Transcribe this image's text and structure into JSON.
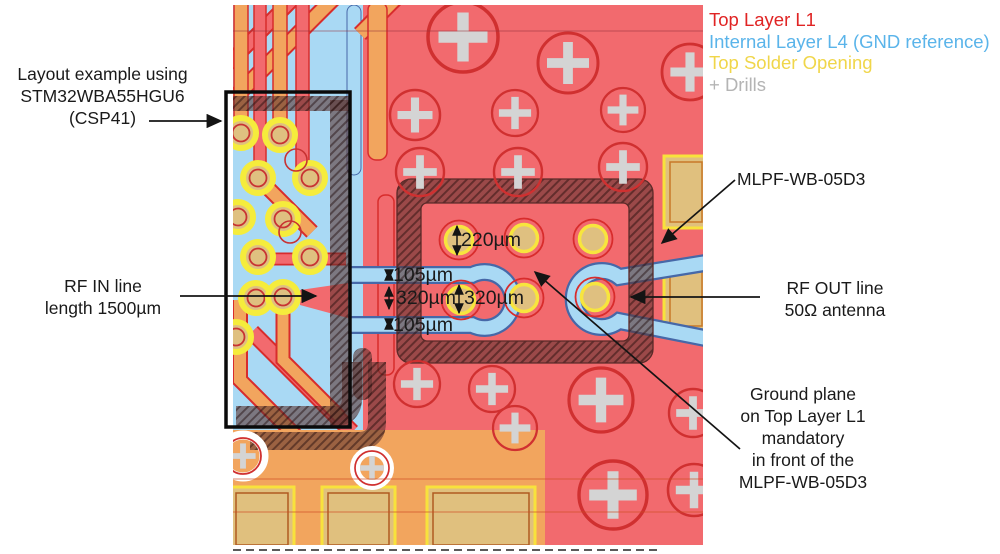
{
  "legend": {
    "items": [
      {
        "label": "Top Layer L1",
        "color": "#e02424"
      },
      {
        "label": "Internal Layer L4 (GND reference)",
        "color": "#5ab4ea"
      },
      {
        "label": "Top Solder Opening",
        "color": "#f0d64a"
      },
      {
        "label": "+ Drills",
        "color": "#b4b4b4"
      }
    ]
  },
  "annotations": {
    "chip": {
      "lines": [
        "Layout example using",
        "STM32WBA55HGU6",
        "(CSP41)"
      ]
    },
    "rf_in": {
      "lines": [
        "RF IN line",
        "length 1500µm"
      ]
    },
    "filter": {
      "label": "MLPF-WB-05D3"
    },
    "rf_out": {
      "lines": [
        "RF OUT line",
        "50Ω antenna"
      ]
    },
    "ground_plane": {
      "lines": [
        "Ground plane",
        "on Top Layer L1",
        "mandatory",
        "in front of the",
        "MLPF-WB-05D3"
      ]
    }
  },
  "dimensions": {
    "pad_opening": "220µm",
    "gap_top": "105µm",
    "trace_width": "320µm",
    "pad_pitch": "320µm",
    "gap_bottom": "105µm"
  },
  "colors": {
    "top_layer": "#f26a6e",
    "top_layer_outline": "#d82c2c",
    "internal_layer": "#a9d9f4",
    "solder_opening": "#f7e53e",
    "pad_fill": "#dfc080",
    "drill_cross": "#d4d4d4"
  }
}
